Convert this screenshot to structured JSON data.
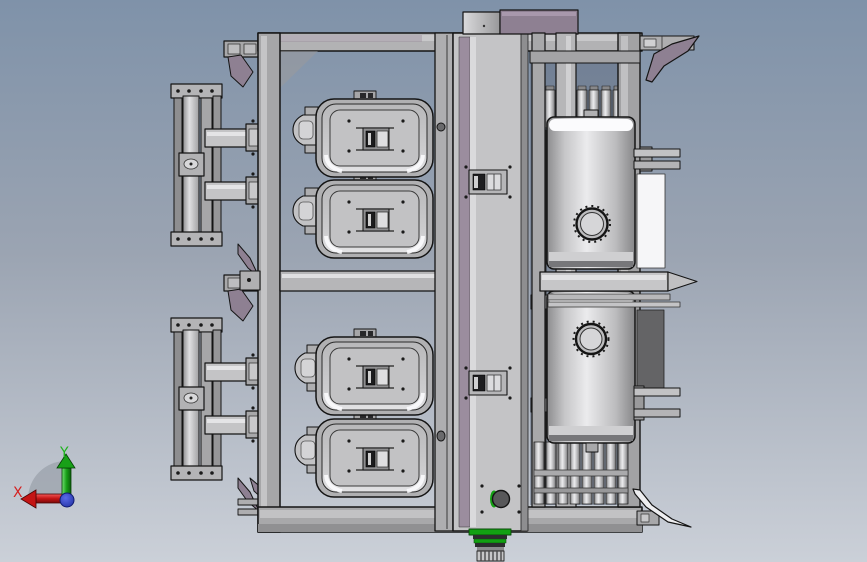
{
  "viewport": {
    "kind": "3D CAD assembly viewport",
    "background_gradient": {
      "top": "#7f92a9",
      "middle": "#9ba4b2",
      "bottom": "#cbd0d8"
    }
  },
  "orientation_triad": {
    "x_label": "X",
    "y_label": "Y",
    "x_axis_color": "#c41414",
    "y_axis_color": "#18a018",
    "origin_dot_color": "#2736c8"
  },
  "model": {
    "outline_color": "#141414",
    "frame_color": "#acacae",
    "panel_color": "#c6c6c8",
    "accent_purple": "#8e8092",
    "accent_green": "#12a012",
    "tank_color": "#e8e8ea",
    "highlight_white": "#f6f6f8",
    "parts": [
      "main-frame",
      "center-tower",
      "seed-box",
      "pressure-tank",
      "left-arm-assembly",
      "drive-sprocket",
      "wing-blade"
    ]
  }
}
